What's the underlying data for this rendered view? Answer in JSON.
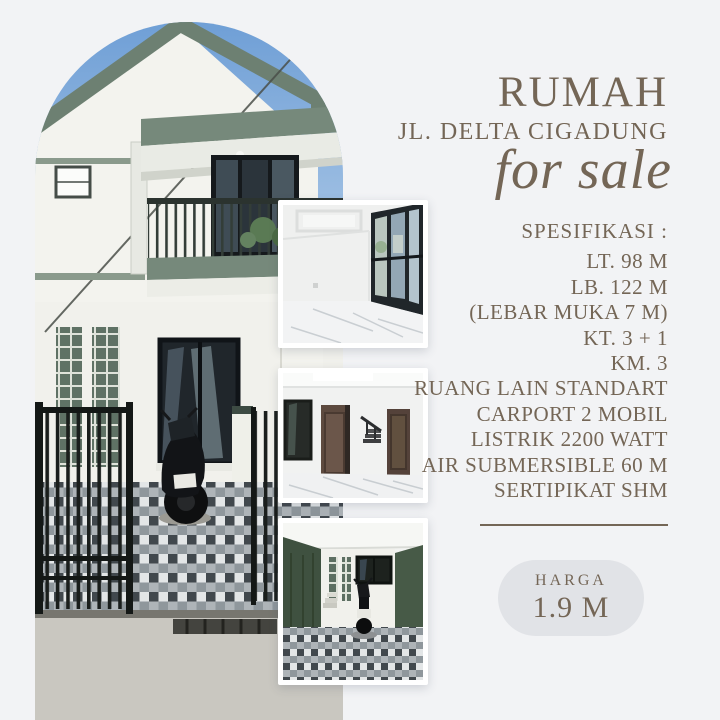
{
  "theme": {
    "background": "#f2f3f5",
    "text_color": "#746656",
    "badge_background": "#e1e3e7",
    "roof_trim_green": "#6d8072",
    "sky_blue": "#6f9fd6"
  },
  "header": {
    "title": "RUMAH",
    "subtitle": "JL. DELTA CIGADUNG",
    "tagline": "for sale"
  },
  "specs": {
    "heading": "SPESIFIKASI :",
    "items": [
      "LT. 98 M",
      "LB. 122 M",
      "(LEBAR MUKA 7 M)",
      "KT. 3 + 1",
      "KM. 3",
      "RUANG LAIN STANDART",
      "CARPORT 2 MOBIL",
      "LISTRIK 2200 WATT",
      "AIR SUBMERSIBLE 60 M",
      "SERTIPIKAT SHM"
    ]
  },
  "price": {
    "label": "HARGA",
    "value": "1.9 M"
  },
  "photos": {
    "main": "two-story white house with sage-green roof trim, balcony, black gate, motorcycle and checkered tile carport under blue sky",
    "thumb1": "empty room with marble floor, tray ceiling and black-framed window wall",
    "thumb2": "hallway with dark wooden doors, staircase and marble floor",
    "thumb3": "carport with checkered tiles, dark green walls and a parked scooter"
  }
}
